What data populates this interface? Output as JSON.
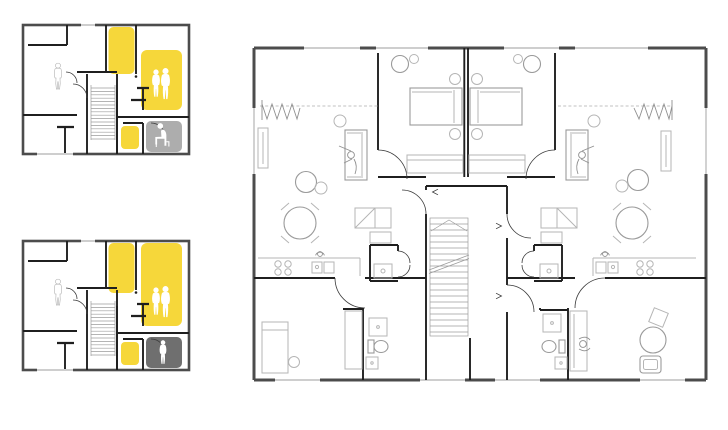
{
  "canvas": {
    "width": 728,
    "height": 430,
    "background": "#ffffff"
  },
  "colors": {
    "background": "#ffffff",
    "wall_outer": "#4c4c4c",
    "wall_inner": "#1f1f1f",
    "furniture": "#b5b5b5",
    "furniture_dark": "#9a9a9a",
    "highlight_yellow": "#f6d73a",
    "zone_gray_light": "#adadad",
    "zone_gray_dark": "#6f6f6f",
    "silhouette_white": "#ffffff",
    "outline_figure": "#a8a8a8"
  },
  "plans": {
    "schematic_top": {
      "name": "small-schematic-plan-variant-a",
      "highlight_color_ref": "highlight_yellow",
      "corner_zone_color_ref": "zone_gray_light",
      "figures": [
        {
          "icon": "standing-person-outline-icon"
        },
        {
          "icon": "couple-silhouette-icon"
        },
        {
          "icon": "seated-person-silhouette-icon"
        }
      ]
    },
    "schematic_bottom": {
      "name": "small-schematic-plan-variant-b",
      "highlight_color_ref": "highlight_yellow",
      "corner_zone_color_ref": "zone_gray_dark",
      "figures": [
        {
          "icon": "standing-person-outline-icon"
        },
        {
          "icon": "couple-silhouette-icon"
        },
        {
          "icon": "standing-person-silhouette-icon"
        }
      ]
    },
    "detailed": {
      "name": "detailed-floor-plan-two-mirrored-apartments",
      "elements": [
        "staircase",
        "beds",
        "sofas",
        "dining-tables",
        "kitchen-counters",
        "bathrooms",
        "toilets",
        "wardrobes",
        "desk"
      ]
    }
  }
}
